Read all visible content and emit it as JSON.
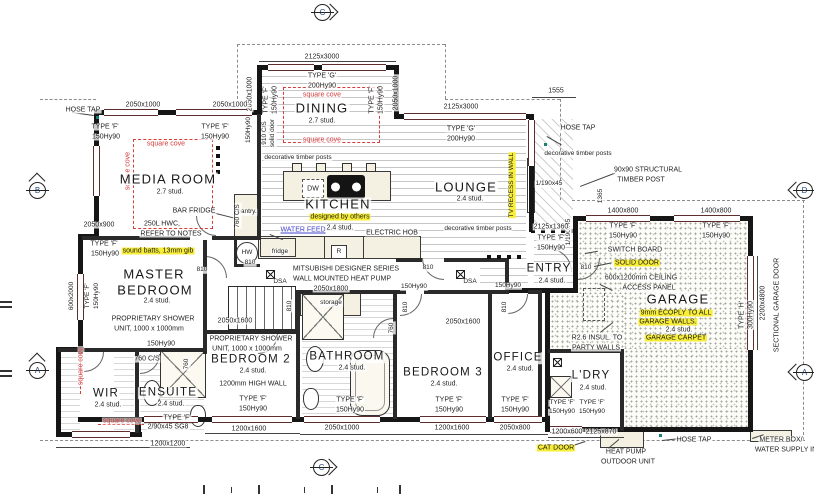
{
  "drawing_colors": {
    "highlight": "#f8ee3a",
    "cove_red": "#d23a3a",
    "water_feed_blue": "#4343cb",
    "wall": "#161616"
  },
  "markers": [
    {
      "n": "elevation-marker-top",
      "l": "C",
      "x": 322,
      "y": 12,
      "d": "right"
    },
    {
      "n": "elevation-marker-left-upper",
      "l": "B",
      "x": 37,
      "y": 190,
      "d": "up"
    },
    {
      "n": "elevation-marker-left-lower",
      "l": "A",
      "x": 37,
      "y": 370,
      "d": "up"
    },
    {
      "n": "elevation-marker-right-upper",
      "l": "D",
      "x": 804,
      "y": 190,
      "d": "left"
    },
    {
      "n": "elevation-marker-right-lower",
      "l": "A",
      "x": 804,
      "y": 372,
      "d": "left"
    },
    {
      "n": "elevation-marker-bottom",
      "l": "C",
      "x": 321,
      "y": 467,
      "d": "right"
    }
  ],
  "labels": [
    {
      "n": "dim-2125x3000-dining",
      "t": "2125x3000",
      "x": 322,
      "y": 57,
      "s": 7
    },
    {
      "n": "type-g-dining",
      "t": "TYPE 'G'",
      "x": 322,
      "y": 76,
      "s": 7
    },
    {
      "n": "hy-200-dining",
      "t": "200Hy90",
      "x": 322,
      "y": 86,
      "s": 7
    },
    {
      "n": "cove-dining-top",
      "t": "square cove",
      "x": 322,
      "y": 95,
      "s": 7,
      "cls": "red"
    },
    {
      "n": "room-dining",
      "t": "DINING",
      "x": 322,
      "y": 108,
      "s": 13,
      "cls": "room"
    },
    {
      "n": "dining-stud",
      "t": "2.7 stud.",
      "x": 322,
      "y": 121,
      "s": 7
    },
    {
      "n": "cove-dining-bottom",
      "t": "square cove",
      "x": 322,
      "y": 140,
      "s": 7,
      "cls": "red"
    },
    {
      "n": "dim-2050x1000-dining-left",
      "t": "2050x1000",
      "x": 250,
      "y": 94,
      "s": 7,
      "cls": "rot"
    },
    {
      "n": "type-f-dining-left",
      "t": "TYPE 'F'",
      "x": 266,
      "y": 100,
      "s": 7,
      "cls": "rot"
    },
    {
      "n": "hy-150-dining-left",
      "t": "150Hy90",
      "x": 275,
      "y": 100,
      "s": 7,
      "cls": "rot"
    },
    {
      "n": "type-f-dining-right",
      "t": "TYPE 'F'",
      "x": 372,
      "y": 100,
      "s": 7,
      "cls": "rot"
    },
    {
      "n": "hy-150-dining-right",
      "t": "150Hy90",
      "x": 381,
      "y": 100,
      "s": 7,
      "cls": "rot"
    },
    {
      "n": "dim-2050x1000-dining-right",
      "t": "2050x1000",
      "x": 396,
      "y": 93,
      "s": 7,
      "cls": "rot"
    },
    {
      "n": "door-910-cs",
      "t": "910 C/S",
      "x": 265,
      "y": 133,
      "s": 6.5,
      "cls": "rot"
    },
    {
      "n": "door-910-solid",
      "t": "solid door",
      "x": 273,
      "y": 133,
      "s": 6.5,
      "cls": "rot"
    },
    {
      "n": "dim-2125x3000-lounge",
      "t": "2125x3000",
      "x": 461,
      "y": 107,
      "s": 7
    },
    {
      "n": "type-g-lounge",
      "t": "TYPE 'G'",
      "x": 461,
      "y": 129,
      "s": 7
    },
    {
      "n": "hy-200-lounge",
      "t": "200Hy90",
      "x": 461,
      "y": 139,
      "s": 7
    },
    {
      "n": "dim-1555",
      "t": "1555",
      "x": 556,
      "y": 91,
      "s": 7
    },
    {
      "n": "hose-tap-ne",
      "t": "HOSE TAP",
      "x": 578,
      "y": 128,
      "s": 7
    },
    {
      "n": "deco-posts-right",
      "t": "decorative timber posts",
      "x": 578,
      "y": 154,
      "s": 6.5
    },
    {
      "n": "structural-post-1",
      "t": "90x90 STRUCTURAL",
      "x": 648,
      "y": 170,
      "s": 7
    },
    {
      "n": "structural-post-2",
      "t": "TIMBER POST",
      "x": 641,
      "y": 180,
      "s": 7
    },
    {
      "n": "dim-1190x45-h",
      "t": "1/190x45",
      "x": 549,
      "y": 184,
      "s": 6.5
    },
    {
      "n": "dim-1190x45-v",
      "t": "1/190x45",
      "x": 569,
      "y": 232,
      "s": 6.5,
      "cls": "rot"
    },
    {
      "n": "dim-1365",
      "t": "1365",
      "x": 601,
      "y": 196,
      "s": 6.5,
      "cls": "rot"
    },
    {
      "n": "dim-2125x1360",
      "t": "2125x1360",
      "x": 551,
      "y": 227,
      "s": 7
    },
    {
      "n": "type-f-entry",
      "t": "TYPE 'F'",
      "x": 551,
      "y": 238,
      "s": 7
    },
    {
      "n": "hy-150-entry",
      "t": "150Hy90",
      "x": 551,
      "y": 248,
      "s": 7
    },
    {
      "n": "room-entry",
      "t": "ENTRY",
      "x": 549,
      "y": 269,
      "s": 11.5,
      "cls": "room"
    },
    {
      "n": "entry-stud",
      "t": "2.4 stud.",
      "x": 552,
      "y": 281,
      "s": 7
    },
    {
      "n": "door-810-entry",
      "t": "810",
      "x": 586,
      "y": 268,
      "s": 6.5
    },
    {
      "n": "dim-1400x800-1",
      "t": "1400x800",
      "x": 623,
      "y": 211,
      "s": 7
    },
    {
      "n": "dim-1400x800-2",
      "t": "1400x800",
      "x": 716,
      "y": 211,
      "s": 7
    },
    {
      "n": "type-f-garage-1",
      "t": "TYPE 'F'",
      "x": 623,
      "y": 226,
      "s": 7
    },
    {
      "n": "hy-150-garage-1",
      "t": "150Hy90",
      "x": 623,
      "y": 236,
      "s": 7
    },
    {
      "n": "type-f-garage-2",
      "t": "TYPE 'F'",
      "x": 716,
      "y": 226,
      "s": 7
    },
    {
      "n": "hy-150-garage-2",
      "t": "150Hy90",
      "x": 716,
      "y": 236,
      "s": 7
    },
    {
      "n": "switch-board",
      "t": "SWITCH BOARD",
      "x": 635,
      "y": 250,
      "s": 7
    },
    {
      "n": "solid-door-note",
      "t": "SOLID DOOR",
      "x": 637,
      "y": 263,
      "s": 7,
      "cls": "hl"
    },
    {
      "n": "ceiling-access-1",
      "t": "600x1200mm CEILING",
      "x": 641,
      "y": 278,
      "s": 7
    },
    {
      "n": "ceiling-access-2",
      "t": "ACCESS PANEL",
      "x": 649,
      "y": 288,
      "s": 7
    },
    {
      "n": "room-garage",
      "t": "GARAGE",
      "x": 678,
      "y": 299,
      "s": 13,
      "cls": "room"
    },
    {
      "n": "ecoply-note-1",
      "t": "9mm ECOPLY TO ALL",
      "x": 676,
      "y": 313,
      "s": 7,
      "cls": "hl"
    },
    {
      "n": "ecoply-note-2",
      "t": "GARAGE WALLS.",
      "x": 668,
      "y": 322,
      "s": 7,
      "cls": "hl"
    },
    {
      "n": "garage-stud",
      "t": "2.4 stud.",
      "x": 679,
      "y": 330,
      "s": 7
    },
    {
      "n": "garage-carpet",
      "t": "GARAGE CARPET",
      "x": 676,
      "y": 338,
      "s": 7,
      "cls": "hl"
    },
    {
      "n": "r26-insul-1",
      "t": "R2.6 INSUL. TO",
      "x": 597,
      "y": 338,
      "s": 7
    },
    {
      "n": "r26-insul-2",
      "t": "PARTY WALLS",
      "x": 596,
      "y": 348,
      "s": 7
    },
    {
      "n": "type-h-garage",
      "t": "TYPE 'H'",
      "x": 742,
      "y": 315,
      "s": 7,
      "cls": "rot"
    },
    {
      "n": "hy-300-garage",
      "t": "300Hy90",
      "x": 751,
      "y": 315,
      "s": 7,
      "cls": "rot"
    },
    {
      "n": "dim-2200x4800",
      "t": "2200x4800",
      "x": 763,
      "y": 303,
      "s": 7,
      "cls": "rot"
    },
    {
      "n": "sectional-garage-door",
      "t": "SECTIONAL GARAGE DOOR",
      "x": 777,
      "y": 305,
      "s": 7,
      "cls": "rot"
    },
    {
      "n": "room-ldry",
      "t": "L'DRY",
      "x": 591,
      "y": 376,
      "s": 11.5,
      "cls": "room"
    },
    {
      "n": "ldry-stud",
      "t": "2.4 stud.",
      "x": 593,
      "y": 388,
      "s": 7
    },
    {
      "n": "type-f-ldry-1",
      "t": "TYPE 'F'",
      "x": 562,
      "y": 403,
      "s": 6.5
    },
    {
      "n": "type-f-ldry-2",
      "t": "TYPE 'F'",
      "x": 592,
      "y": 403,
      "s": 6.5
    },
    {
      "n": "hy-150-ldry-1",
      "t": "150Hy90",
      "x": 562,
      "y": 412,
      "s": 6.5
    },
    {
      "n": "hy-150-ldry-2",
      "t": "150Hy90",
      "x": 592,
      "y": 412,
      "s": 6.5
    },
    {
      "n": "dim-1200x600",
      "t": "1200x600",
      "x": 567,
      "y": 432,
      "s": 7
    },
    {
      "n": "dim-2125x870",
      "t": "2125x870",
      "x": 601,
      "y": 432,
      "s": 7
    },
    {
      "n": "cat-door",
      "t": "CAT DOOR",
      "x": 556,
      "y": 448,
      "s": 7,
      "cls": "hl"
    },
    {
      "n": "heat-pump-1",
      "t": "HEAT PUMP",
      "x": 626,
      "y": 452,
      "s": 7
    },
    {
      "n": "heat-pump-2",
      "t": "OUTDOOR UNIT",
      "x": 628,
      "y": 462,
      "s": 7
    },
    {
      "n": "hose-tap-s",
      "t": "HOSE TAP",
      "x": 694,
      "y": 440,
      "s": 7
    },
    {
      "n": "meter-box-1",
      "t": "METER BOX/",
      "x": 781,
      "y": 440,
      "s": 7
    },
    {
      "n": "meter-box-2",
      "t": "WATER SUPPLY IN",
      "x": 786,
      "y": 450,
      "s": 7
    },
    {
      "n": "hose-tap-nw",
      "t": "HOSE TAP",
      "x": 83,
      "y": 110,
      "s": 7
    },
    {
      "n": "dim-2050x1000-media-1",
      "t": "2050x1000",
      "x": 143,
      "y": 105,
      "s": 7
    },
    {
      "n": "dim-2050x1000-media-2",
      "t": "2050x1000",
      "x": 230,
      "y": 105,
      "s": 7
    },
    {
      "n": "type-f-media-1",
      "t": "TYPE 'F'",
      "x": 105,
      "y": 127,
      "s": 7
    },
    {
      "n": "hy-150-media-1",
      "t": "150Hy90",
      "x": 106,
      "y": 137,
      "s": 7
    },
    {
      "n": "type-f-media-2",
      "t": "TYPE 'F'",
      "x": 215,
      "y": 127,
      "s": 7
    },
    {
      "n": "hy-150-media-2",
      "t": "150Hy90",
      "x": 215,
      "y": 137,
      "s": 7
    },
    {
      "n": "hy-150-media-3",
      "t": "150Hy90",
      "x": 249,
      "y": 130,
      "s": 6.5,
      "cls": "rot"
    },
    {
      "n": "cove-media-left",
      "t": "square cove",
      "x": 128,
      "y": 171,
      "s": 7,
      "cls": "rot red"
    },
    {
      "n": "cove-media-top",
      "t": "square cove",
      "x": 166,
      "y": 144,
      "s": 7,
      "cls": "red"
    },
    {
      "n": "room-media",
      "t": "MEDIA ROOM",
      "x": 168,
      "y": 179,
      "s": 13,
      "cls": "room"
    },
    {
      "n": "media-stud",
      "t": "2.7 stud.",
      "x": 170,
      "y": 192,
      "s": 7
    },
    {
      "n": "bar-fridge",
      "t": "BAR FRIDGE",
      "x": 194,
      "y": 211,
      "s": 7
    },
    {
      "n": "hwc-note-1",
      "t": "250L HWC,",
      "x": 162,
      "y": 224,
      "s": 7
    },
    {
      "n": "hwc-note-2",
      "t": "REFER TO NOTES",
      "x": 171,
      "y": 234,
      "s": 7
    },
    {
      "n": "pantry",
      "t": "pantry.",
      "x": 247,
      "y": 212,
      "s": 6.5
    },
    {
      "n": "door-760-cs-pantry",
      "t": "760 C/S",
      "x": 238,
      "y": 216,
      "s": 6.5,
      "cls": "rot"
    },
    {
      "n": "dim-2050x900",
      "t": "2050x900",
      "x": 99,
      "y": 225,
      "s": 7
    },
    {
      "n": "type-f-media-4",
      "t": "TYPE 'F'",
      "x": 104,
      "y": 244,
      "s": 7
    },
    {
      "n": "hy-150-media-4",
      "t": "150Hy90",
      "x": 105,
      "y": 254,
      "s": 7
    },
    {
      "n": "sound-batts",
      "t": "sound batts, 13mm gib",
      "x": 158,
      "y": 251,
      "s": 7,
      "cls": "hl"
    },
    {
      "n": "hw-cylinder",
      "t": "HW",
      "x": 247,
      "y": 253,
      "s": 6.5
    },
    {
      "n": "door-810-hw",
      "t": "810",
      "x": 250,
      "y": 263,
      "s": 6.5
    },
    {
      "n": "door-810-master",
      "t": "810",
      "x": 202,
      "y": 270,
      "s": 6.5
    },
    {
      "n": "deco-posts-left",
      "t": "decorative timber posts",
      "x": 298,
      "y": 158,
      "s": 6.5
    },
    {
      "n": "dw",
      "t": "DW",
      "x": 313,
      "y": 189,
      "s": 7
    },
    {
      "n": "room-kitchen",
      "t": "KITCHEN",
      "x": 338,
      "y": 204,
      "s": 13,
      "cls": "room"
    },
    {
      "n": "designed-by-others",
      "t": "designed by others",
      "x": 340,
      "y": 217,
      "s": 7,
      "cls": "hl"
    },
    {
      "n": "water-feed",
      "t": "WATER FEED",
      "x": 303,
      "y": 230,
      "s": 7,
      "cls": "blue"
    },
    {
      "n": "kitchen-stud",
      "t": "2.4 stud.",
      "x": 340,
      "y": 228,
      "s": 7
    },
    {
      "n": "electric-hob",
      "t": "ELECTRIC HOB",
      "x": 392,
      "y": 233,
      "s": 7
    },
    {
      "n": "fridge",
      "t": "fridge",
      "x": 280,
      "y": 252,
      "s": 6.5
    },
    {
      "n": "range-r",
      "t": "R",
      "x": 339,
      "y": 252,
      "s": 6.5
    },
    {
      "n": "room-lounge",
      "t": "LOUNGE",
      "x": 466,
      "y": 187,
      "s": 13,
      "cls": "room"
    },
    {
      "n": "lounge-stud",
      "t": "2.4 stud.",
      "x": 470,
      "y": 199,
      "s": 7
    },
    {
      "n": "tv-recess",
      "t": "TV RECESS IN WALL",
      "x": 512,
      "y": 185,
      "s": 6.5,
      "cls": "rot hl"
    },
    {
      "n": "deco-posts-mid",
      "t": "decorative timber posts",
      "x": 478,
      "y": 229,
      "s": 6.5
    },
    {
      "n": "mitsubishi-1",
      "t": "MITSUBISHI DESIGNER SERIES",
      "x": 346,
      "y": 269,
      "s": 7
    },
    {
      "n": "mitsubishi-2",
      "t": "WALL MOUNTED HEAT PUMP",
      "x": 342,
      "y": 279,
      "s": 7
    },
    {
      "n": "dim-2050x1800",
      "t": "2050x1800",
      "x": 331,
      "y": 289,
      "s": 7
    },
    {
      "n": "door-810-lounge",
      "t": "810",
      "x": 428,
      "y": 268,
      "s": 6.5
    },
    {
      "n": "hy-150-hall-1",
      "t": "150Hy90",
      "x": 414,
      "y": 287,
      "s": 6.5
    },
    {
      "n": "dsa-1",
      "t": "DSA",
      "x": 280,
      "y": 282,
      "s": 6.5
    },
    {
      "n": "dsa-2",
      "t": "DSA",
      "x": 470,
      "y": 282,
      "s": 6.5
    },
    {
      "n": "hy-150-hall-2",
      "t": "150Hy90",
      "x": 508,
      "y": 286,
      "s": 6.5
    },
    {
      "n": "room-master-1",
      "t": "MASTER",
      "x": 154,
      "y": 274,
      "s": 13,
      "cls": "room"
    },
    {
      "n": "room-master-2",
      "t": "BEDROOM",
      "x": 155,
      "y": 290,
      "s": 13,
      "cls": "room"
    },
    {
      "n": "master-stud",
      "t": "2.4 stud.",
      "x": 157,
      "y": 301,
      "s": 7
    },
    {
      "n": "type-f-master",
      "t": "TYPE 'F'",
      "x": 88,
      "y": 296,
      "s": 6.5,
      "cls": "rot"
    },
    {
      "n": "hy-150-master",
      "t": "150Hy90",
      "x": 97,
      "y": 296,
      "s": 6.5,
      "cls": "rot"
    },
    {
      "n": "dim-600x2000",
      "t": "600x2000",
      "x": 72,
      "y": 296,
      "s": 6.5,
      "cls": "rot"
    },
    {
      "n": "shower-note-1a",
      "t": "PROPRIETARY SHOWER",
      "x": 153,
      "y": 319,
      "s": 7
    },
    {
      "n": "shower-note-1b",
      "t": "UNIT, 1000 x 1000mm",
      "x": 149,
      "y": 329,
      "s": 7
    },
    {
      "n": "hy-150-ensuite",
      "t": "150Hy90",
      "x": 161,
      "y": 344,
      "s": 7
    },
    {
      "n": "door-760-cs-ens",
      "t": "760 C/S",
      "x": 147,
      "y": 359,
      "s": 7
    },
    {
      "n": "dim-760-wir",
      "t": "760",
      "x": 187,
      "y": 364,
      "s": 6.5,
      "cls": "rot"
    },
    {
      "n": "dim-2050x1600-hall",
      "t": "2050x1600",
      "x": 235,
      "y": 321,
      "s": 7
    },
    {
      "n": "shower-note-2a",
      "t": "PROPRIETARY SHOWER",
      "x": 251,
      "y": 339,
      "s": 7
    },
    {
      "n": "shower-note-2b",
      "t": "UNIT, 1000 x 1000mm",
      "x": 247,
      "y": 349,
      "s": 7
    },
    {
      "n": "door-810-bed2",
      "t": "810",
      "x": 290,
      "y": 306,
      "s": 6.5,
      "cls": "rot"
    },
    {
      "n": "room-bed2",
      "t": "BEDROOM 2",
      "x": 251,
      "y": 360,
      "s": 11.5,
      "cls": "room"
    },
    {
      "n": "bed2-stud",
      "t": "2.4 stud.",
      "x": 253,
      "y": 371,
      "s": 7
    },
    {
      "n": "high-wall-note",
      "t": "1200mm HIGH WALL",
      "x": 253,
      "y": 384,
      "s": 7
    },
    {
      "n": "type-f-bed2",
      "t": "TYPE 'F'",
      "x": 253,
      "y": 399,
      "s": 7
    },
    {
      "n": "hy-150-bed2",
      "t": "150Hy90",
      "x": 253,
      "y": 409,
      "s": 7
    },
    {
      "n": "dim-1200x1600-bed2",
      "t": "1200x1600",
      "x": 249,
      "y": 429,
      "s": 7
    },
    {
      "n": "cove-wir",
      "t": "square cove",
      "x": 81,
      "y": 366,
      "s": 7,
      "cls": "rot red"
    },
    {
      "n": "room-wir",
      "t": "WIR",
      "x": 106,
      "y": 394,
      "s": 11.5,
      "cls": "room"
    },
    {
      "n": "wir-stud",
      "t": "2.4 stud.",
      "x": 108,
      "y": 405,
      "s": 7
    },
    {
      "n": "room-ensuite",
      "t": "ENSUITE",
      "x": 168,
      "y": 393,
      "s": 11.5,
      "cls": "room"
    },
    {
      "n": "ensuite-stud",
      "t": "2.4 stud.",
      "x": 171,
      "y": 404,
      "s": 7
    },
    {
      "n": "type-f-ensuite",
      "t": "TYPE 'F'",
      "x": 177,
      "y": 418,
      "s": 7
    },
    {
      "n": "sg8-note",
      "t": "2/90x45 SG8",
      "x": 168,
      "y": 427,
      "s": 7
    },
    {
      "n": "cove-ensuite",
      "t": "square cove",
      "x": 122,
      "y": 421,
      "s": 7,
      "cls": "red"
    },
    {
      "n": "dim-1200x1200",
      "t": "1200x1200",
      "x": 168,
      "y": 444,
      "s": 7
    },
    {
      "n": "storage",
      "t": "storage",
      "x": 331,
      "y": 303,
      "s": 6.5
    },
    {
      "n": "dim-760-bath",
      "t": "760",
      "x": 392,
      "y": 328,
      "s": 6.5,
      "cls": "rot"
    },
    {
      "n": "door-810-bed3",
      "t": "810",
      "x": 406,
      "y": 307,
      "s": 6.5,
      "cls": "rot"
    },
    {
      "n": "door-810-office",
      "t": "810",
      "x": 505,
      "y": 307,
      "s": 6.5,
      "cls": "rot"
    },
    {
      "n": "dim-2050x1600-bed3",
      "t": "2050x1600",
      "x": 463,
      "y": 322,
      "s": 7
    },
    {
      "n": "room-bathroom",
      "t": "BATHROOM",
      "x": 347,
      "y": 357,
      "s": 11.5,
      "cls": "room"
    },
    {
      "n": "bathroom-stud",
      "t": "2.4 stud.",
      "x": 352,
      "y": 368,
      "s": 7
    },
    {
      "n": "room-bed3",
      "t": "BEDROOM 3",
      "x": 443,
      "y": 373,
      "s": 11.5,
      "cls": "room"
    },
    {
      "n": "bed3-stud",
      "t": "2.4 stud.",
      "x": 444,
      "y": 384,
      "s": 7
    },
    {
      "n": "room-office",
      "t": "OFFICE",
      "x": 518,
      "y": 358,
      "s": 11.5,
      "cls": "room"
    },
    {
      "n": "office-stud",
      "t": "2.4 stud.",
      "x": 520,
      "y": 369,
      "s": 7
    },
    {
      "n": "type-f-bath",
      "t": "TYPE 'F'",
      "x": 350,
      "y": 400,
      "s": 7
    },
    {
      "n": "hy-150-bath",
      "t": "150Hy90",
      "x": 350,
      "y": 410,
      "s": 7
    },
    {
      "n": "type-f-bed3",
      "t": "TYPE 'F'",
      "x": 449,
      "y": 400,
      "s": 7
    },
    {
      "n": "hy-150-bed3",
      "t": "150Hy90",
      "x": 449,
      "y": 410,
      "s": 7
    },
    {
      "n": "type-f-office",
      "t": "TYPE 'F'",
      "x": 515,
      "y": 400,
      "s": 7
    },
    {
      "n": "hy-150-office",
      "t": "150Hy90",
      "x": 515,
      "y": 410,
      "s": 7
    },
    {
      "n": "dim-2050x1000-bath",
      "t": "2050x1000",
      "x": 342,
      "y": 428,
      "s": 7
    },
    {
      "n": "dim-1200x1600-bed3",
      "t": "1200x1600",
      "x": 452,
      "y": 428,
      "s": 7
    },
    {
      "n": "dim-2050x800",
      "t": "2050x800",
      "x": 515,
      "y": 428,
      "s": 7
    }
  ]
}
